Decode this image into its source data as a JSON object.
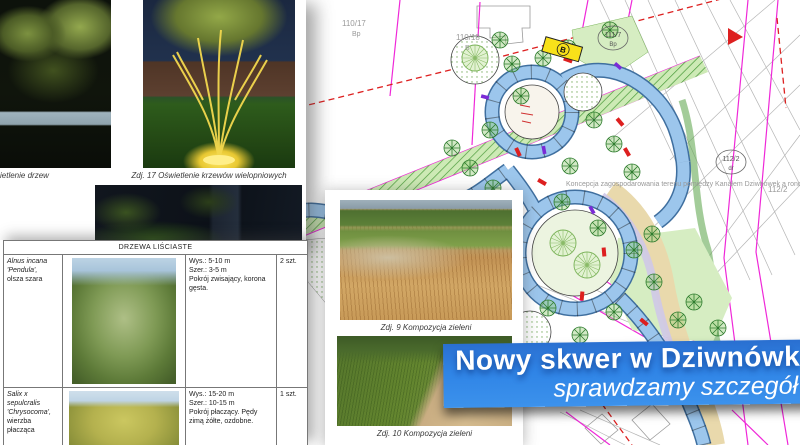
{
  "banner": {
    "line1": "Nowy skwer w Dziwnówk",
    "line2": "sprawdzamy szczegół",
    "bg_color": "#2f84e6"
  },
  "left_page": {
    "caption_left": "ietlenie drzew",
    "caption_right": "Zdj. 17 Oświetlenie krzewów wielopniowych"
  },
  "plan": {
    "caption": "Koncepcja zagospodarowania terenu pomiędzy Kanałem Dziwnówek a rondem w miejscowości Dziwnówek",
    "colors": {
      "boundary_magenta": "#ef28d8",
      "line_red": "#dd2020",
      "greenery": "#4a9a3a",
      "path_blue": "#9cc6ec"
    },
    "labels": {
      "parcel1": "110/17",
      "parcel1_type": "Bp",
      "parcel2": "110/18",
      "parcel2_type": "B",
      "parcel3": "111/7",
      "parcel3_type": "Bp",
      "parcel4": "112/2",
      "parcel4_type": "dr",
      "parcel5": "112/2",
      "bus_stop": "B",
      "area_code": "K1"
    }
  },
  "photos_page": {
    "caption_top": "Zdj. 9 Kompozycja zieleni",
    "caption_bottom": "Zdj. 10 Kompozycja zieleni"
  },
  "table": {
    "header": "DRZEWA LIŚCIASTE",
    "rows": [
      {
        "name_l1": "Alnus incana",
        "name_l2": "'Pendula',",
        "name_l3": "olsza szara",
        "d1": "Wys.: 5-10 m",
        "d2": "Szer.: 3-5 m",
        "d3": "Pokrój zwisający, korona gęsta.",
        "qty": "2 szt."
      },
      {
        "name_l1": "Salix x sepulcralis",
        "name_l2": "'Chrysocoma',",
        "name_l3": "wierzba płacząca",
        "d1": "Wys.: 15-20 m",
        "d2": "Szer.: 10-15 m",
        "d3": "Pokrój płaczący. Pędy zimą żółte, ozdobne.",
        "qty": "1 szt."
      }
    ]
  }
}
